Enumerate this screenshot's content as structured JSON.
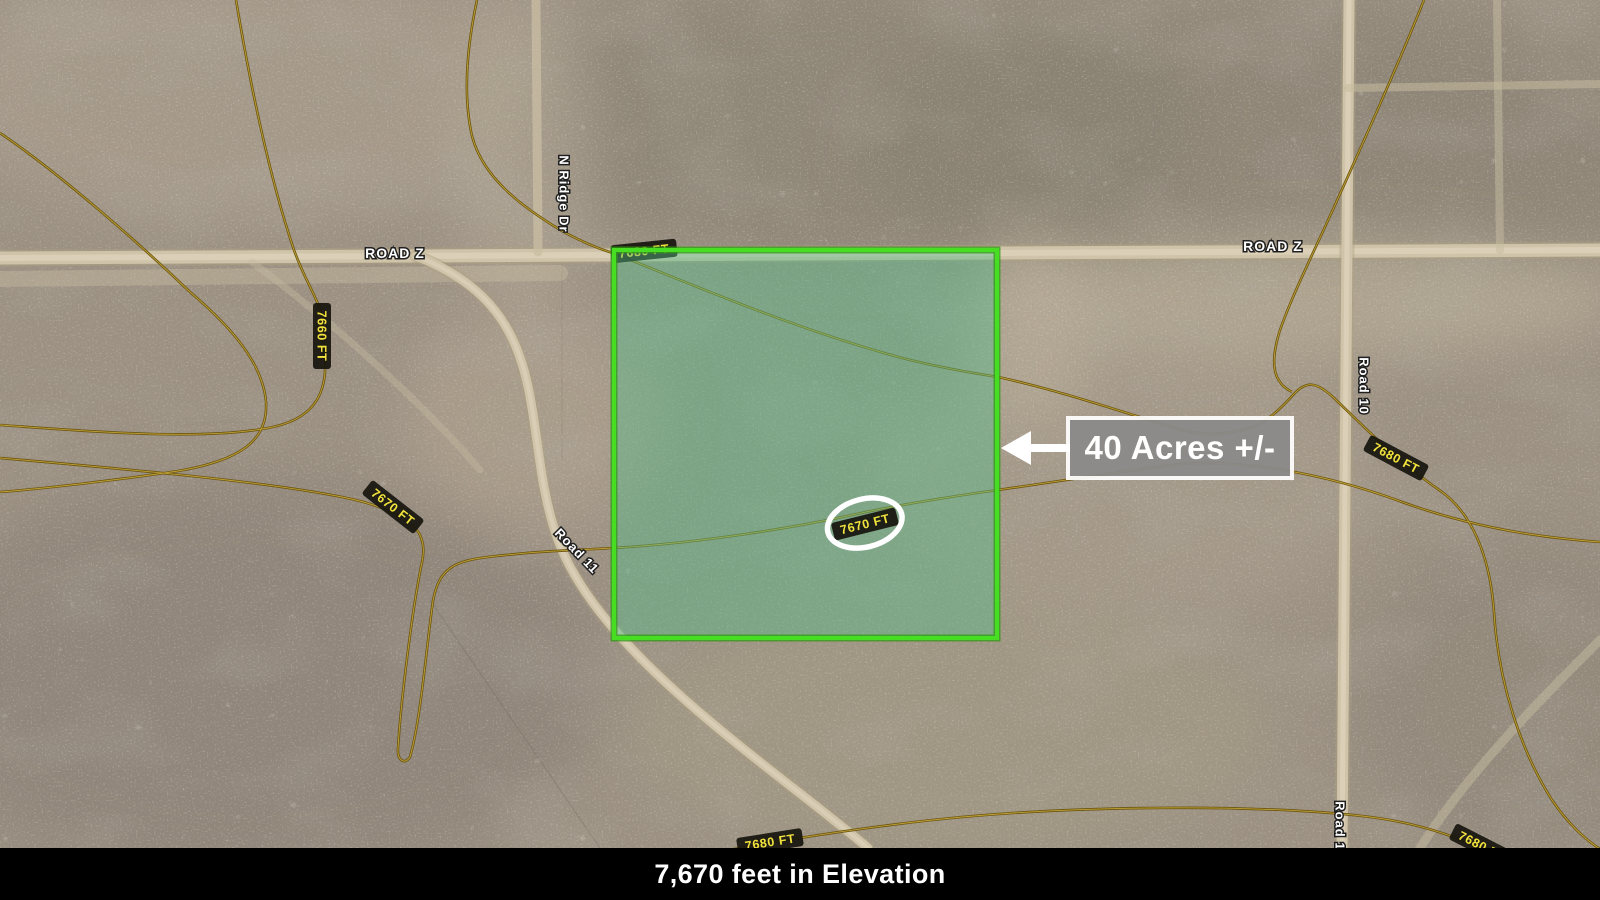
{
  "map": {
    "annotation": {
      "area_label": "40 Acres +/-"
    },
    "caption": {
      "text": "7,670 feet in Elevation"
    },
    "roads": {
      "labels": [
        {
          "id": "road-z-west",
          "text": "ROAD Z"
        },
        {
          "id": "road-z-east",
          "text": "ROAD Z"
        },
        {
          "id": "n-ridge-dr",
          "text": "N Ridge Dr"
        },
        {
          "id": "road-11",
          "text": "Road 11"
        },
        {
          "id": "road-10",
          "text": "Road 10"
        },
        {
          "id": "road-10-south",
          "text": "Road 10"
        }
      ]
    },
    "contours": {
      "labels": [
        {
          "id": "west-7660",
          "text": "7660 FT"
        },
        {
          "id": "west-7670",
          "text": "7670 FT"
        },
        {
          "id": "parcel-7670-circled",
          "text": "7670 FT"
        },
        {
          "id": "corner-7680",
          "text": "7680 FT"
        },
        {
          "id": "east-7680",
          "text": "7680 FT"
        },
        {
          "id": "south-7680",
          "text": "7680 FT"
        },
        {
          "id": "southeast-7680",
          "text": "7680 FT"
        }
      ]
    },
    "colors": {
      "terrain_base": "#9c9183",
      "road_surface": "#cfc4a9",
      "contour_line": "#6a5612",
      "contour_label_text": "#f2e33c",
      "contour_label_bg": "#17160e",
      "parcel_fill": "#54bf8a",
      "parcel_border": "#46dd22",
      "annotation_box": "#8a8a8a",
      "annotation_border": "#ffffff",
      "caption_bg": "#000000",
      "caption_text": "#ffffff"
    }
  }
}
